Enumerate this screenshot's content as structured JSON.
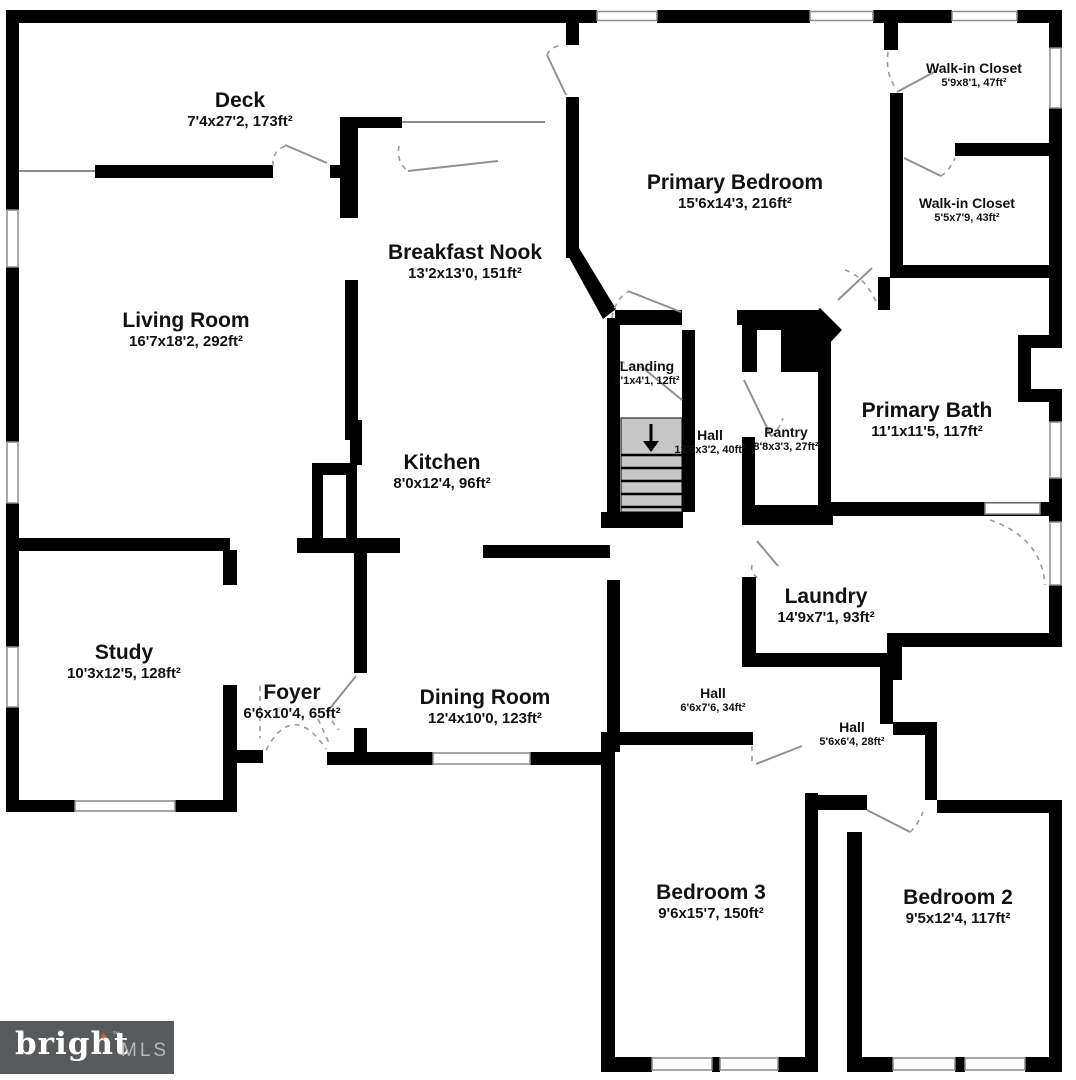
{
  "plan": {
    "title": "Floor plan",
    "rooms": [
      {
        "name": "Deck",
        "dims": "7'4x27'2, 173ft²"
      },
      {
        "name": "Living Room",
        "dims": "16'7x18'2, 292ft²"
      },
      {
        "name": "Breakfast Nook",
        "dims": "13'2x13'0, 151ft²"
      },
      {
        "name": "Primary Bedroom",
        "dims": "15'6x14'3, 216ft²"
      },
      {
        "name": "Walk-in Closet",
        "dims": "5'9x8'1, 47ft²"
      },
      {
        "name": "Walk-in Closet",
        "dims": "5'5x7'9, 43ft²"
      },
      {
        "name": "Landing",
        "dims": "3'1x4'1, 12ft²"
      },
      {
        "name": "Hall",
        "dims": "12'6x3'2, 40ft²"
      },
      {
        "name": "Pantry",
        "dims": "8'8x3'3, 27ft²"
      },
      {
        "name": "Primary Bath",
        "dims": "11'1x11'5, 117ft²"
      },
      {
        "name": "Kitchen",
        "dims": "8'0x12'4, 96ft²"
      },
      {
        "name": "Study",
        "dims": "10'3x12'5, 128ft²"
      },
      {
        "name": "Foyer",
        "dims": "6'6x10'4, 65ft²"
      },
      {
        "name": "Dining Room",
        "dims": "12'4x10'0, 123ft²"
      },
      {
        "name": "Laundry",
        "dims": "14'9x7'1, 93ft²"
      },
      {
        "name": "Hall",
        "dims": "6'6x7'6, 34ft²"
      },
      {
        "name": "Hall",
        "dims": "5'6x6'4, 28ft²"
      },
      {
        "name": "Bedroom 3",
        "dims": "9'6x15'7, 150ft²"
      },
      {
        "name": "Bedroom 2",
        "dims": "9'5x12'4, 117ft²"
      }
    ],
    "colors": {
      "wall": "#000000",
      "door_swing": "#909090",
      "stair_fill": "#c6c6c6",
      "logo_background": "#58595b",
      "logo_star": "#e4572e",
      "logo_mls_text": "#b5b6b8"
    },
    "logo": {
      "brand": "bright",
      "star": "✦",
      "tm": "™",
      "suffix": "MLS"
    }
  }
}
